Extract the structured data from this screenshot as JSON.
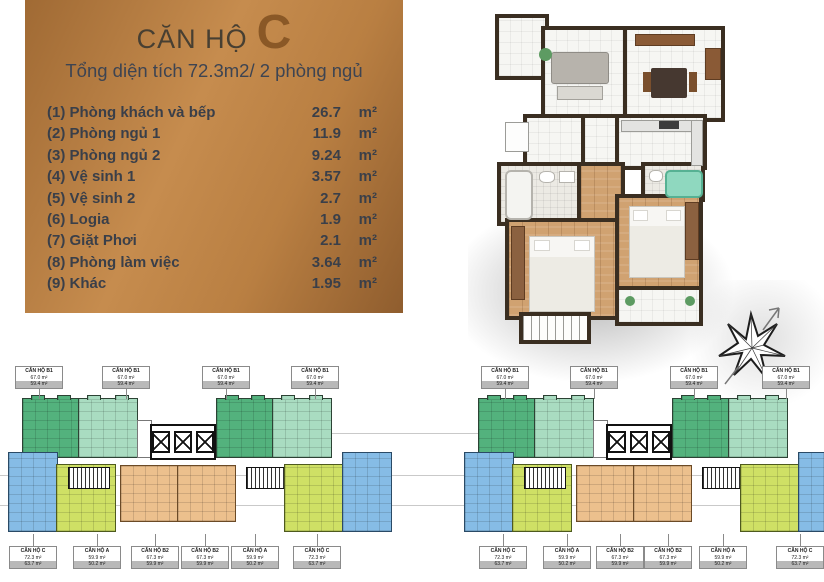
{
  "panel": {
    "title_prefix": "CĂN HỘ",
    "title_letter": "C",
    "subtitle": "Tổng diện tích 72.3m2/ 2 phòng ngủ",
    "rooms": [
      {
        "label": "(1) Phòng khách và bếp",
        "area": "26.7",
        "unit": "m²"
      },
      {
        "label": "(2) Phòng ngủ 1",
        "area": "11.9",
        "unit": "m²"
      },
      {
        "label": "(3) Phòng ngủ 2",
        "area": "9.24",
        "unit": "m²"
      },
      {
        "label": "(4) Vệ sinh 1",
        "area": "3.57",
        "unit": "m²"
      },
      {
        "label": "(5) Vệ sinh 2",
        "area": "2.7",
        "unit": "m²"
      },
      {
        "label": "(6) Logia",
        "area": "1.9",
        "unit": "m²"
      },
      {
        "label": "(7) Giặt Phơi",
        "area": "2.1",
        "unit": "m²"
      },
      {
        "label": "(8) Phòng làm việc",
        "area": "3.64",
        "unit": "m²"
      },
      {
        "label": "(9) Khác",
        "area": "1.95",
        "unit": "m²"
      }
    ],
    "colors": {
      "panel_from": "#a06a34",
      "panel_to": "#8f5d2e",
      "accent_letter": "#8a5826"
    }
  },
  "site": {
    "top_labels": [
      {
        "name": "CĂN HỘ B1",
        "gross": "67.0 m²",
        "net": "59.4 m²"
      },
      {
        "name": "CĂN HỘ B1",
        "gross": "67.0 m²",
        "net": "59.4 m²"
      },
      {
        "name": "CĂN HỘ B1",
        "gross": "67.0 m²",
        "net": "59.4 m²"
      },
      {
        "name": "CĂN HỘ B1",
        "gross": "67.0 m²",
        "net": "59.4 m²"
      },
      {
        "name": "CĂN HỘ B1",
        "gross": "67.0 m²",
        "net": "59.4 m²"
      },
      {
        "name": "CĂN HỘ B1",
        "gross": "67.0 m²",
        "net": "59.4 m²"
      },
      {
        "name": "CĂN HỘ B1",
        "gross": "67.0 m²",
        "net": "59.4 m²"
      },
      {
        "name": "CĂN HỘ B1",
        "gross": "67.0 m²",
        "net": "59.4 m²"
      }
    ],
    "bottom_labels": [
      {
        "name": "CĂN HỘ C",
        "gross": "72.3 m²",
        "net": "63.7 m²"
      },
      {
        "name": "CĂN HỘ A",
        "gross": "59.9 m²",
        "net": "50.2 m²"
      },
      {
        "name": "CĂN HỘ B2",
        "gross": "67.3 m²",
        "net": "59.9 m²"
      },
      {
        "name": "CĂN HỘ B2",
        "gross": "67.3 m²",
        "net": "59.9 m²"
      },
      {
        "name": "CĂN HỘ A",
        "gross": "59.9 m²",
        "net": "50.2 m²"
      },
      {
        "name": "CĂN HỘ C",
        "gross": "72.3 m²",
        "net": "63.7 m²"
      },
      {
        "name": "CĂN HỘ C",
        "gross": "72.3 m²",
        "net": "63.7 m²"
      },
      {
        "name": "CĂN HỘ A",
        "gross": "59.9 m²",
        "net": "50.2 m²"
      },
      {
        "name": "CĂN HỘ B2",
        "gross": "67.3 m²",
        "net": "59.9 m²"
      },
      {
        "name": "CĂN HỘ B2",
        "gross": "67.3 m²",
        "net": "59.9 m²"
      },
      {
        "name": "CĂN HỘ A",
        "gross": "59.9 m²",
        "net": "50.2 m²"
      },
      {
        "name": "CĂN HỘ C",
        "gross": "72.3 m²",
        "net": "63.7 m²"
      }
    ],
    "colors": {
      "unit_dark_green": "#53b27d",
      "unit_light_green": "#a9dcc1",
      "unit_blue": "#86bce6",
      "unit_yellow": "#cfe065",
      "unit_orange": "#ecc08d"
    }
  }
}
